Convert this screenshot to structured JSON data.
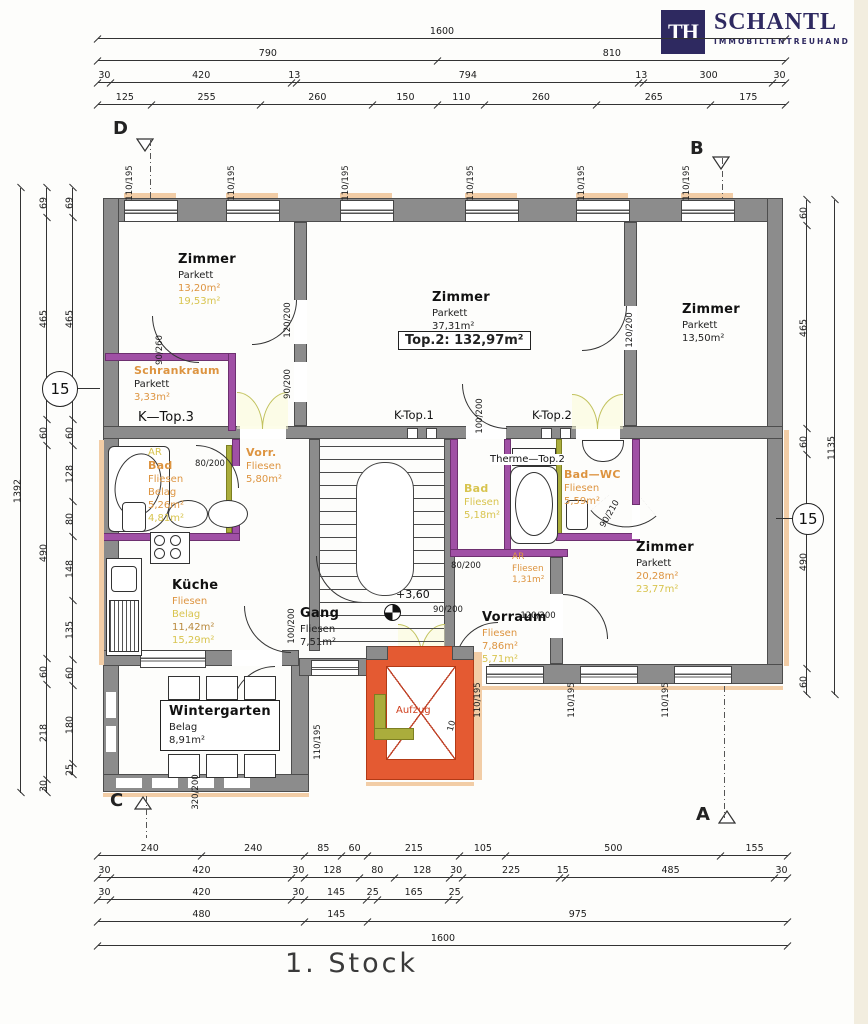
{
  "brand": {
    "monogram": "TH",
    "name": "SCHANTL",
    "subtitle": "IMMOBILIENTREUHAND"
  },
  "floor_title": "1. Stock",
  "unit_label": "Top.2:  132,97m²",
  "level_marker": "+3,60",
  "section_markers": {
    "top_left": "D",
    "top_right": "B",
    "bottom_left": "C",
    "bottom_right": "A"
  },
  "axis_bubbles": {
    "left": "15",
    "right": "15"
  },
  "flue_labels": {
    "k_top1": "K-Top.1",
    "k_top2": "K-Top.2",
    "k_top3": "K—Top.3"
  },
  "therme_label": "Therme—Top.2",
  "rooms": {
    "zimmer_tl": {
      "name": "Zimmer",
      "material": "Parkett",
      "area1": "13,20m²",
      "area2": "19,53m²"
    },
    "zimmer_tc": {
      "name": "Zimmer",
      "material": "Parkett",
      "area1": "37,31m²"
    },
    "zimmer_tr": {
      "name": "Zimmer",
      "material": "Parkett",
      "area1": "13,50m²"
    },
    "schrankraum": {
      "name": "Schrankraum",
      "material": "Parkett",
      "area1": "3,33m²"
    },
    "vorr": {
      "name": "Vorr.",
      "material": "Fliesen",
      "area1": "5,80m²"
    },
    "bad_left": {
      "pre": "AR",
      "name": "Bad",
      "material": "Fliesen",
      "material2": "Belag",
      "area1": "5,26m²",
      "area2": "4,81m²"
    },
    "bad_center": {
      "name": "Bad",
      "material": "Fliesen",
      "area1": "5,18m²"
    },
    "bad_wc": {
      "name": "Bad—WC",
      "material": "Fliesen",
      "area1": "5,59m²"
    },
    "ar_center": {
      "name": "AR",
      "material": "Fliesen",
      "area1": "1,31m²"
    },
    "kueche": {
      "name": "Küche",
      "material": "Fliesen",
      "material2": "Belag",
      "area1": "11,42m²",
      "area2": "15,29m²"
    },
    "gang": {
      "name": "Gang",
      "material": "Fliesen",
      "area1": "7,51m²"
    },
    "vorraum": {
      "name": "Vorraum",
      "material": "Fliesen",
      "area1": "7,86m²",
      "area2": "5,71m²"
    },
    "zimmer_r": {
      "name": "Zimmer",
      "material": "Parkett",
      "area1": "20,28m²",
      "area2": "23,77m²"
    },
    "wintergarten": {
      "name": "Wintergarten",
      "material": "Belag",
      "area1": "8,91m²"
    },
    "aufzug": {
      "name": "Aufzug"
    }
  },
  "colors": {
    "wall_gray": "#8c8c8c",
    "new_wall_purple": "#a050a5",
    "new_wall_green": "#aaad3c",
    "new_construction_red": "#e45a32",
    "existing_peach": "#f2cda6",
    "area_text_orange": "#dd9440",
    "area_text_yellow": "#d8c44f",
    "brand_navy": "#2e2960"
  },
  "dim_chains": [
    {
      "id": "top-overall",
      "dir": "h",
      "x": 98,
      "y": 26,
      "len": 688,
      "values": [
        1600
      ]
    },
    {
      "id": "top-2",
      "dir": "h",
      "x": 98,
      "y": 48,
      "len": 688,
      "values": [
        790,
        810
      ]
    },
    {
      "id": "top-3",
      "dir": "h",
      "x": 98,
      "y": 70,
      "len": 688,
      "values": [
        30,
        420,
        13,
        794,
        13,
        300,
        30
      ]
    },
    {
      "id": "top-4",
      "dir": "h",
      "x": 98,
      "y": 92,
      "len": 688,
      "values": [
        125,
        255,
        260,
        150,
        110,
        260,
        265,
        175
      ]
    },
    {
      "id": "bottom-1",
      "dir": "h",
      "x": 98,
      "y": 843,
      "len": 690,
      "values": [
        240,
        240,
        85,
        60,
        215,
        105,
        500,
        155
      ]
    },
    {
      "id": "bottom-2",
      "dir": "h",
      "x": 98,
      "y": 865,
      "len": 690,
      "values": [
        30,
        420,
        30,
        128,
        80,
        128,
        30,
        225,
        15,
        485,
        30
      ]
    },
    {
      "id": "bottom-3",
      "dir": "h",
      "x": 98,
      "y": 887,
      "len": 362,
      "values": [
        30,
        420,
        30,
        145,
        25,
        165,
        25
      ]
    },
    {
      "id": "bottom-4",
      "dir": "h",
      "x": 98,
      "y": 909,
      "len": 690,
      "values": [
        480,
        145,
        975
      ]
    },
    {
      "id": "bottom-overall",
      "dir": "h",
      "x": 98,
      "y": 933,
      "len": 690,
      "values": [
        1600
      ]
    },
    {
      "id": "left-overall",
      "dir": "v",
      "x": 8,
      "y": 188,
      "len": 605,
      "values": [
        1392
      ]
    },
    {
      "id": "left-outer",
      "dir": "v",
      "x": 34,
      "y": 188,
      "len": 605,
      "values": [
        69,
        465,
        60,
        490,
        60,
        218,
        30
      ]
    },
    {
      "id": "left-inner",
      "dir": "v",
      "x": 60,
      "y": 188,
      "len": 587,
      "values": [
        69,
        465,
        60,
        128,
        80,
        148,
        135,
        60,
        180,
        25
      ]
    },
    {
      "id": "right-inner",
      "dir": "v",
      "x": 794,
      "y": 200,
      "len": 495,
      "values": [
        60,
        465,
        60,
        490,
        60
      ]
    },
    {
      "id": "right-overall",
      "dir": "v",
      "x": 822,
      "y": 200,
      "len": 495,
      "values": [
        1135
      ]
    }
  ],
  "opening_dims": [
    {
      "t": "110/195",
      "x": 130,
      "y": 183,
      "r": -90
    },
    {
      "t": "110/195",
      "x": 232,
      "y": 183,
      "r": -90
    },
    {
      "t": "110/195",
      "x": 346,
      "y": 183,
      "r": -90
    },
    {
      "t": "110/195",
      "x": 471,
      "y": 183,
      "r": -90
    },
    {
      "t": "110/195",
      "x": 582,
      "y": 183,
      "r": -90
    },
    {
      "t": "110/195",
      "x": 687,
      "y": 183,
      "r": -90
    },
    {
      "t": "90/260",
      "x": 160,
      "y": 350,
      "r": -90
    },
    {
      "t": "120/200",
      "x": 288,
      "y": 320,
      "r": -90
    },
    {
      "t": "90/200",
      "x": 288,
      "y": 384,
      "r": -90
    },
    {
      "t": "100/200",
      "x": 480,
      "y": 416,
      "r": -90
    },
    {
      "t": "120/200",
      "x": 630,
      "y": 330,
      "r": -90
    },
    {
      "t": "80/200",
      "x": 210,
      "y": 464,
      "r": 0
    },
    {
      "t": "80/200",
      "x": 466,
      "y": 566,
      "r": 0
    },
    {
      "t": "90/200",
      "x": 448,
      "y": 610,
      "r": 0
    },
    {
      "t": "120/200",
      "x": 538,
      "y": 616,
      "r": 0
    },
    {
      "t": "90/210",
      "x": 610,
      "y": 514,
      "r": -60
    },
    {
      "t": "100/200",
      "x": 292,
      "y": 626,
      "r": -90
    },
    {
      "t": "110/195",
      "x": 478,
      "y": 700,
      "r": -90
    },
    {
      "t": "110/195",
      "x": 572,
      "y": 700,
      "r": -90
    },
    {
      "t": "110/195",
      "x": 666,
      "y": 700,
      "r": -90
    },
    {
      "t": "110/195",
      "x": 318,
      "y": 742,
      "r": -90
    },
    {
      "t": "320/200",
      "x": 196,
      "y": 792,
      "r": -90
    },
    {
      "t": "10",
      "x": 452,
      "y": 726,
      "r": -75
    }
  ]
}
